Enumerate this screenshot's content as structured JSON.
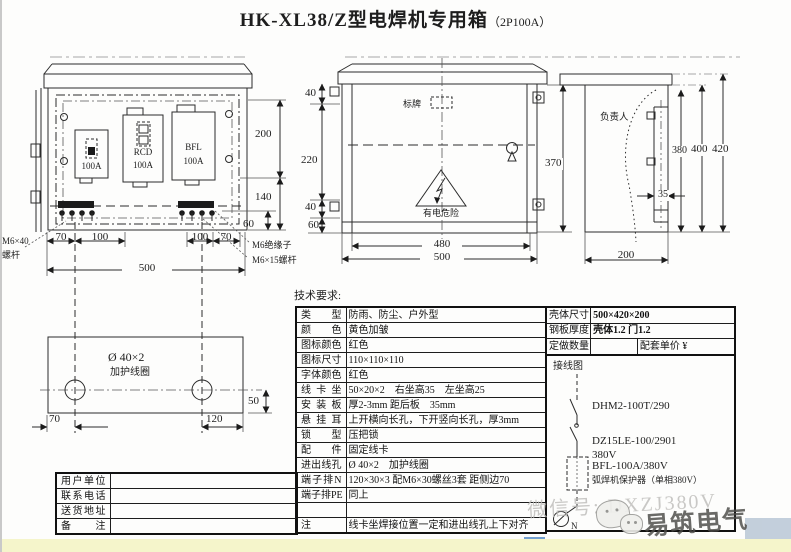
{
  "title": {
    "main": "HK-XL38/Z型电焊机专用箱",
    "suffix": "（2P100A）"
  },
  "colors": {
    "line": "#2b2b2b",
    "strip_yellow": "#f5f5cb",
    "watermark_gray": "#bdbcb9",
    "wm_blue_dark": "#5b8fc9",
    "wm_blue_light": "#b9c7d6"
  },
  "front_view": {
    "device1_amp": "100A",
    "device2_name": "RCD",
    "device2_amp": "100A",
    "device3_name": "BFL",
    "device3_amp": "100A",
    "dims": {
      "h200": "200",
      "h140": "140",
      "h60": "60",
      "w70l": "70",
      "w100l": "100",
      "w100r": "100",
      "w70r": "70",
      "w500": "500"
    },
    "label_bolt_left_1": "M6×40",
    "label_bolt_left_2": "螺杆",
    "label_insulator": "M6绝缘子",
    "label_bolt_right": "M6×15螺杆"
  },
  "door_view": {
    "nameplate": "标牌",
    "warning_text": "有电危险",
    "dims": {
      "t40": "40",
      "l220": "220",
      "b40": "40",
      "b60": "60",
      "r370": "370",
      "w480": "480",
      "w500": "500"
    }
  },
  "side_view": {
    "person_label": "负责人",
    "dims": {
      "h380": "380",
      "h400": "400",
      "h420": "420",
      "d35": "35",
      "w200": "200"
    }
  },
  "coil_view": {
    "dia_label": "Ø 40×2",
    "coil_label": "加护线圈",
    "dims": {
      "v50": "50",
      "h70": "70",
      "h120": "120"
    }
  },
  "tech_table": {
    "heading": "技术要求:",
    "rows": [
      {
        "label": "类型",
        "value": "防雨、防尘、户外型"
      },
      {
        "label": "颜色",
        "value": "黄色加皱"
      },
      {
        "label": "图标颜色",
        "value": "红色"
      },
      {
        "label": "图标尺寸",
        "value": "110×110×110"
      },
      {
        "label": "字体颜色",
        "value": "红色"
      },
      {
        "label": "线卡坐",
        "value": "50×20×2　右坐高35　左坐高25"
      },
      {
        "label": "安装板",
        "value": "厚2-3mm 距后板　35mm"
      },
      {
        "label": "悬挂耳",
        "value": "上开横向长孔，下开竖向长孔，厚3mm"
      },
      {
        "label": "锁型",
        "value": "压把锁"
      },
      {
        "label": "配件",
        "value": "固定线卡"
      },
      {
        "label": "进出线孔",
        "value": "Ø 40×2　加护线圈"
      },
      {
        "label": "端子排N",
        "value": "120×30×3 配M6×30螺丝3套 距侧边70"
      },
      {
        "label": "端子排PE",
        "value": "同上"
      },
      {
        "label": "",
        "value": ""
      },
      {
        "label": "注",
        "value": "线卡坐焊接位置一定和进出线孔上下对齐"
      }
    ]
  },
  "spec_table": {
    "shell_size_label": "壳体尺寸",
    "shell_size_value": "500×420×200",
    "steel_label": "钢板厚度",
    "steel_value": "壳体1.2 门1.2",
    "qty_label": "定做数量",
    "qty_value": "",
    "price_label": "配套单价",
    "price_currency": "¥",
    "wiring_label": "接线图"
  },
  "wiring": {
    "switch_model": "DHM2-100T/290",
    "breaker_model": "DZ15LE-100/2901",
    "breaker_voltage": "380V",
    "protector_model": "BFL-100A/380V",
    "protector_desc": "弧焊机保护器（单相380V）",
    "neutral_label": "N"
  },
  "customer_table": {
    "rows": [
      {
        "label": "用户单位",
        "value": ""
      },
      {
        "label": "联系电话",
        "value": ""
      },
      {
        "label": "送货地址",
        "value": ""
      },
      {
        "label": "备注",
        "value": ""
      }
    ]
  },
  "watermark": {
    "wechat_id": "微信号: DXZJ380V",
    "brand": "易筑电气"
  }
}
